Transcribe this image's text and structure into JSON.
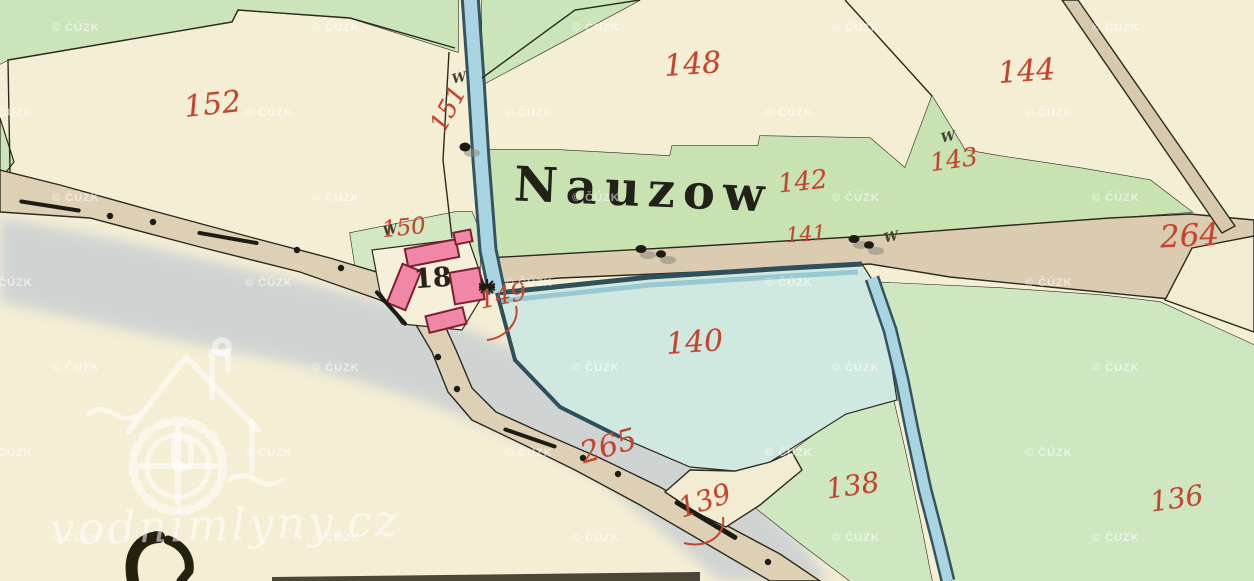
{
  "map": {
    "village_name": "Nauzow",
    "house_number": "18",
    "parcel_numbers": [
      {
        "id": "152"
      },
      {
        "id": "151"
      },
      {
        "id": "150"
      },
      {
        "id": "149"
      },
      {
        "id": "148"
      },
      {
        "id": "144"
      },
      {
        "id": "143"
      },
      {
        "id": "142"
      },
      {
        "id": "141"
      },
      {
        "id": "264"
      },
      {
        "id": "140"
      },
      {
        "id": "265"
      },
      {
        "id": "139"
      },
      {
        "id": "138"
      },
      {
        "id": "136"
      }
    ],
    "symbols": {
      "meadow_mark": "W"
    }
  },
  "watermarks": {
    "provider": "© ČÚZK",
    "site": "vodnimlyny.cz"
  },
  "colors": {
    "paper": "#f4eed4",
    "meadow_green": "#cde5ba",
    "pond_blue": "#cfe9e1",
    "stream_blue": "#a9d5e3",
    "water_edge": "#2f4f5a",
    "road_tan": "#ded0b5",
    "river_gray": "#c7ced2",
    "building_pink": "#f087a6",
    "building_outline": "#7c1f31",
    "ink_black": "#26241a",
    "ink_red": "#c2452f"
  }
}
